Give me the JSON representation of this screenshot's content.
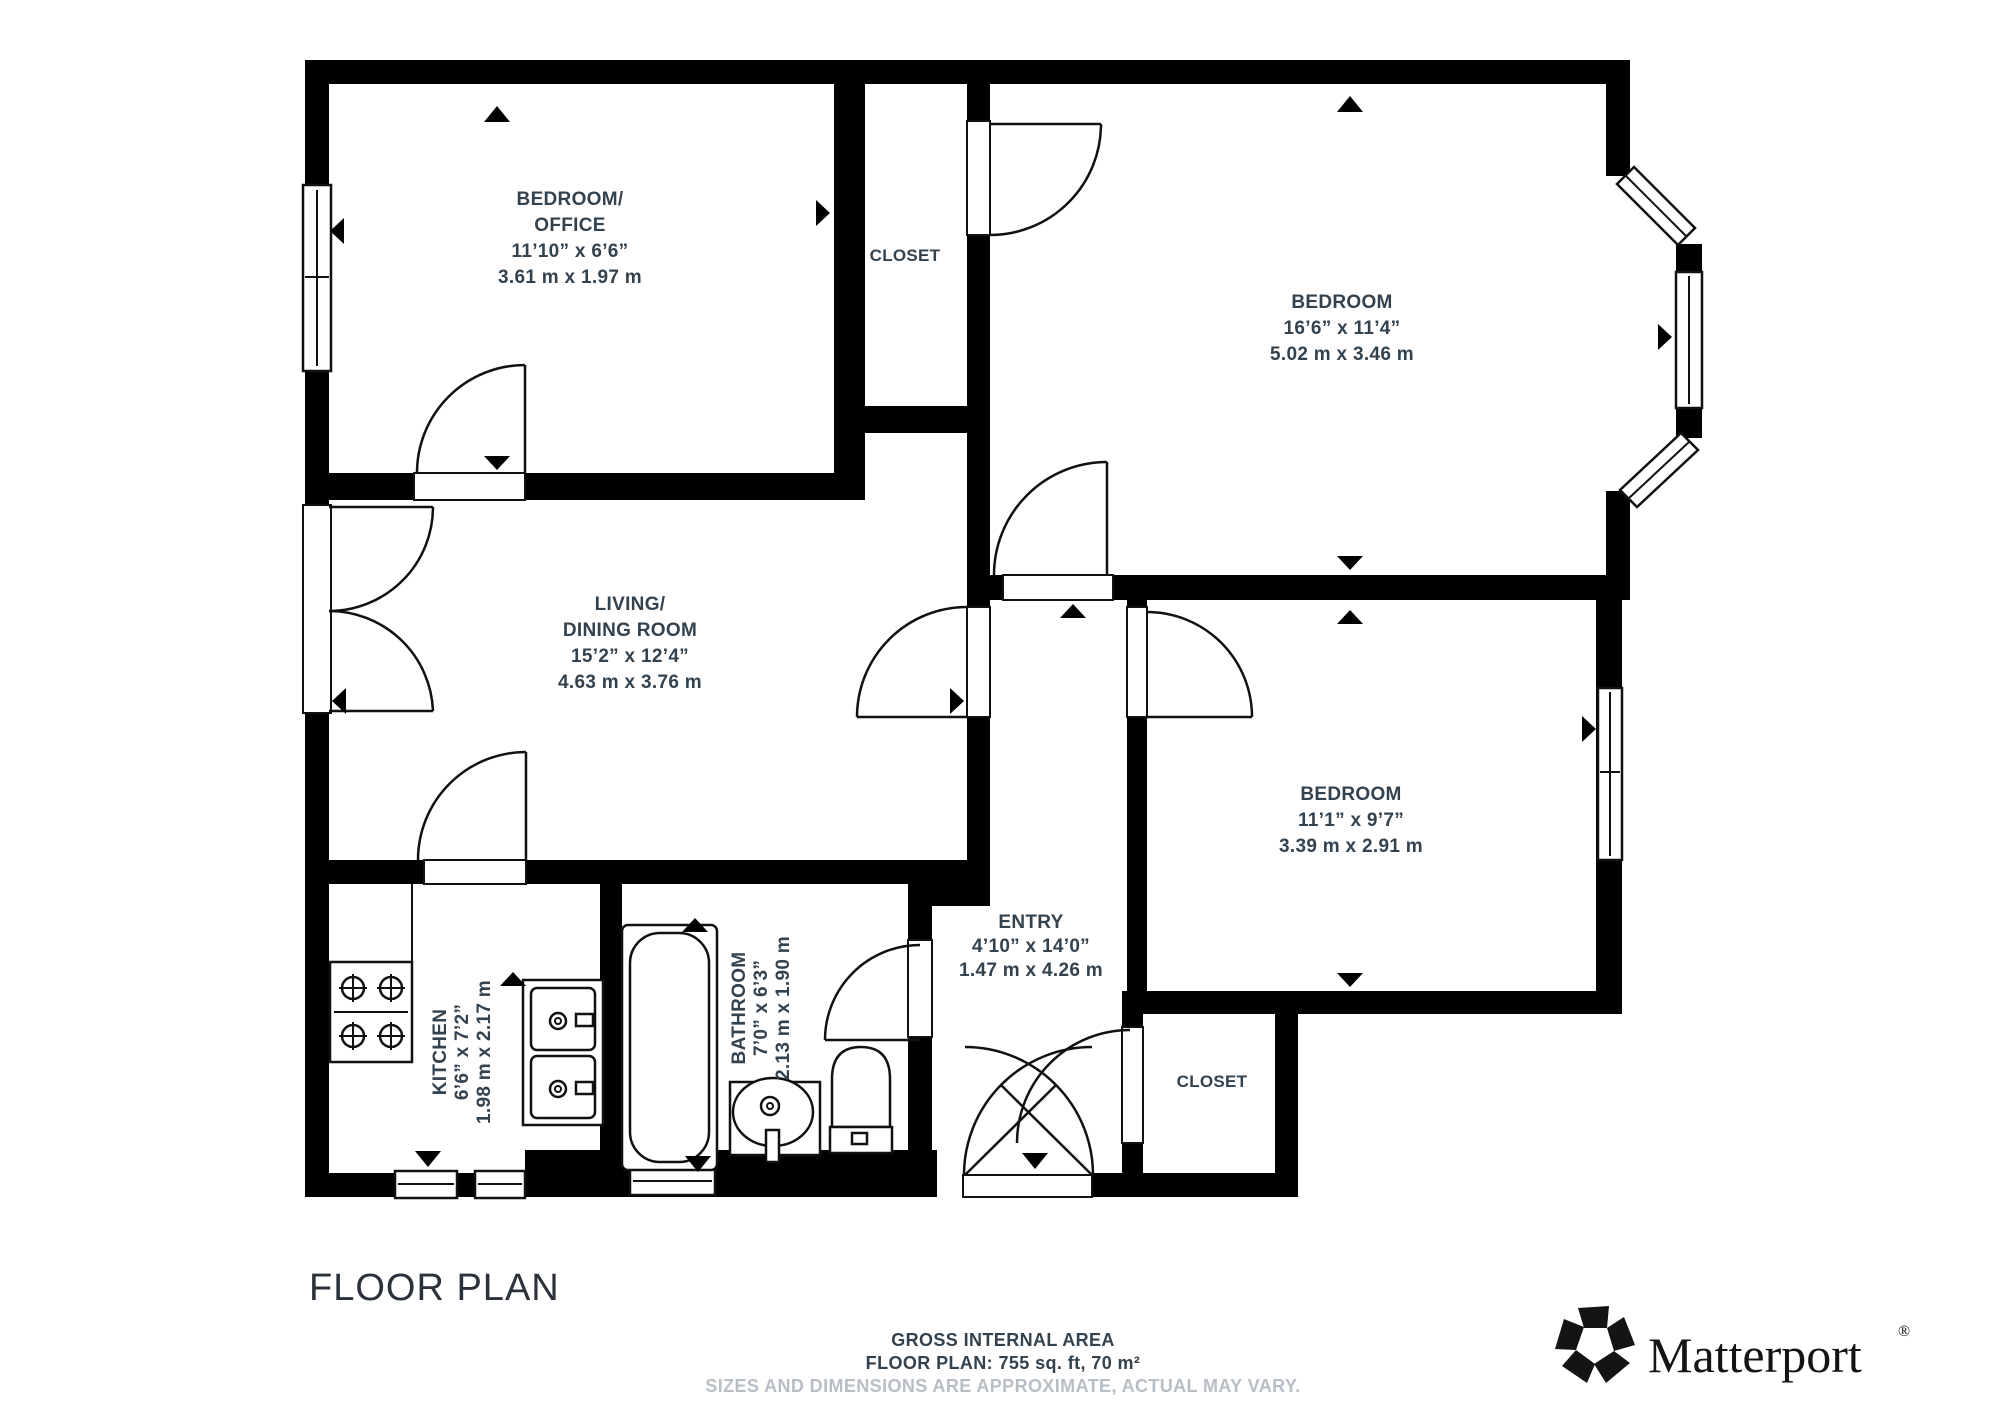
{
  "plan": {
    "title": "FLOOR PLAN",
    "rooms": {
      "bedroom_office": {
        "lines": [
          "BEDROOM/",
          "OFFICE",
          "11’10” x 6’6”",
          "3.61 m x 1.97 m"
        ]
      },
      "closet_top": {
        "lines": [
          "CLOSET"
        ]
      },
      "bedroom_top_right": {
        "lines": [
          "BEDROOM",
          "16’6” x 11’4”",
          "5.02 m x 3.46 m"
        ]
      },
      "living_dining": {
        "lines": [
          "LIVING/",
          "DINING ROOM",
          "15’2” x 12’4”",
          "4.63 m x 3.76 m"
        ]
      },
      "bedroom_lower_right": {
        "lines": [
          "BEDROOM",
          "11’1” x 9’7”",
          "3.39 m x 2.91 m"
        ]
      },
      "entry": {
        "lines": [
          "ENTRY",
          "4’10” x 14’0”",
          "1.47 m x 4.26 m"
        ]
      },
      "kitchen": {
        "lines": [
          "KITCHEN",
          "6’6” x 7’2”",
          "1.98 m x 2.17 m"
        ]
      },
      "bathroom": {
        "lines": [
          "BATHROOM",
          "7’0” x 6’3”",
          "2.13 m x 1.90 m"
        ]
      },
      "closet_bottom": {
        "lines": [
          "CLOSET"
        ]
      }
    },
    "footer": {
      "area_label": "GROSS INTERNAL AREA",
      "area_value": "FLOOR PLAN: 755 sq. ft, 70 m²",
      "disclaimer": "SIZES AND DIMENSIONS ARE APPROXIMATE, ACTUAL MAY VARY."
    },
    "brand": {
      "name": "Matterport",
      "registered_mark": "®"
    },
    "colors": {
      "wall": "#000000",
      "label": "#33424f",
      "disclaimer": "#b8bec5",
      "background": "#ffffff"
    }
  }
}
